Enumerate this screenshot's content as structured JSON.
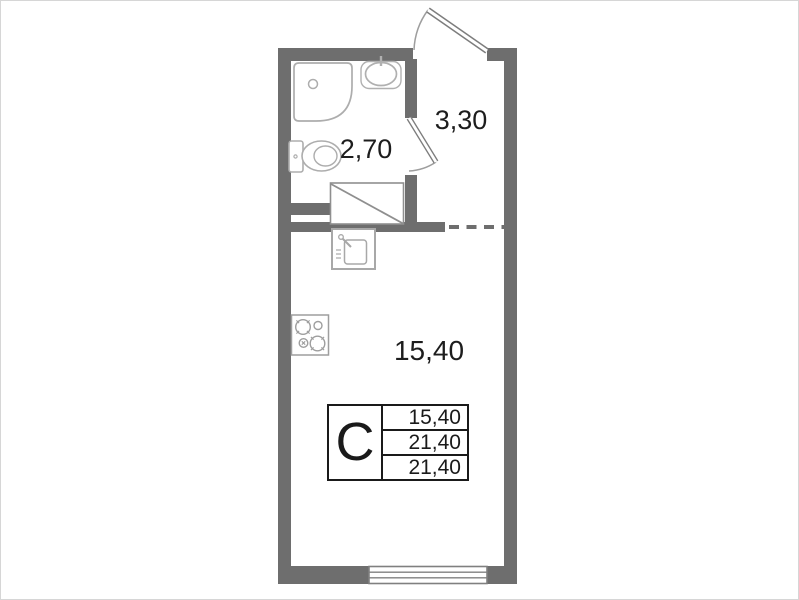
{
  "rooms": {
    "bathroom": {
      "area": "2,70"
    },
    "hallway": {
      "area": "3,30"
    },
    "living_kitchen": {
      "area": "15,40"
    }
  },
  "legend": {
    "type_letter": "C",
    "rows": [
      "15,40",
      "21,40",
      "21,40"
    ]
  },
  "icons": [
    "shower-icon",
    "washbasin-icon",
    "toilet-icon",
    "kitchen-sink-icon",
    "stove-icon",
    "vent-shaft-icon",
    "window-icon",
    "entrance-door-icon",
    "bathroom-door-icon"
  ],
  "colors": {
    "wall": "#6e6e6e",
    "fixture_outline": "#ababab",
    "text": "#1d1d1d",
    "table_border": "#1a1a1a",
    "background": "#ffffff"
  }
}
